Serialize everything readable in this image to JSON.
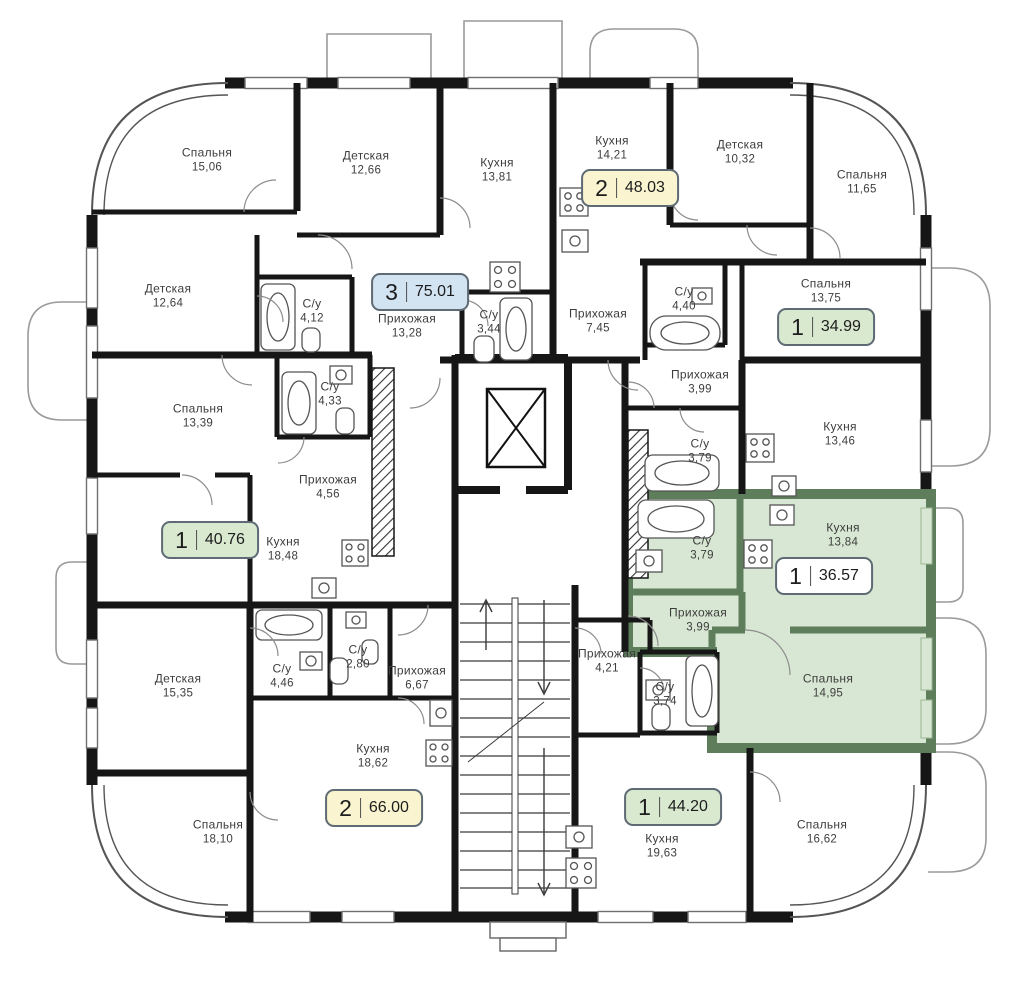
{
  "plan": {
    "language": "ru",
    "type": "residential-floor-plan",
    "colors": {
      "wall": "#161616",
      "highlight_wall": "#5e7d5a",
      "highlight_fill": "#d8e7d3",
      "badge_one_room": "#d8e9d0",
      "badge_two_room": "#faf5d0",
      "badge_three_room": "#d2e3f2",
      "badge_highlighted": "#ffffff"
    },
    "icons": {
      "elevator": "elevator-shaft-x",
      "stairs": "staircase-arrows",
      "bathtub": "bathtub-outline",
      "stove": "stove-4-burners",
      "sink": "sink-basin",
      "toilet": "toilet-outline",
      "door": "door-swing-arc"
    }
  },
  "apartments": [
    {
      "rooms": "3",
      "area": "75.01",
      "style": "blue"
    },
    {
      "rooms": "2",
      "area": "48.03",
      "style": "yellow"
    },
    {
      "rooms": "1",
      "area": "34.99",
      "style": "green"
    },
    {
      "rooms": "1",
      "area": "36.57",
      "style": "white",
      "highlighted": true
    },
    {
      "rooms": "1",
      "area": "40.76",
      "style": "green"
    },
    {
      "rooms": "2",
      "area": "66.00",
      "style": "yellow"
    },
    {
      "rooms": "1",
      "area": "44.20",
      "style": "green"
    }
  ],
  "rooms": [
    {
      "name": "Спальня",
      "area": "15,06"
    },
    {
      "name": "Детская",
      "area": "12,66"
    },
    {
      "name": "Кухня",
      "area": "13,81"
    },
    {
      "name": "Кухня",
      "area": "14,21"
    },
    {
      "name": "Детская",
      "area": "10,32"
    },
    {
      "name": "Спальня",
      "area": "11,65"
    },
    {
      "name": "Детская",
      "area": "12,64"
    },
    {
      "name": "С/у",
      "area": "4,12"
    },
    {
      "name": "Прихожая",
      "area": "13,28"
    },
    {
      "name": "С/у",
      "area": "3,44"
    },
    {
      "name": "Прихожая",
      "area": "7,45"
    },
    {
      "name": "С/у",
      "area": "4,40"
    },
    {
      "name": "Спальня",
      "area": "13,75"
    },
    {
      "name": "Прихожая",
      "area": "3,99"
    },
    {
      "name": "С/у",
      "area": "3,79"
    },
    {
      "name": "Кухня",
      "area": "13,46"
    },
    {
      "name": "С/у",
      "area": "3,79"
    },
    {
      "name": "Кухня",
      "area": "13,84"
    },
    {
      "name": "Прихожая",
      "area": "3,99"
    },
    {
      "name": "Спальня",
      "area": "14,95"
    },
    {
      "name": "Спальня",
      "area": "13,39"
    },
    {
      "name": "С/у",
      "area": "4,33"
    },
    {
      "name": "Прихожая",
      "area": "4,56"
    },
    {
      "name": "Кухня",
      "area": "18,48"
    },
    {
      "name": "Детская",
      "area": "15,35"
    },
    {
      "name": "С/у",
      "area": "4,46"
    },
    {
      "name": "С/у",
      "area": "2,80"
    },
    {
      "name": "Прихожая",
      "area": "6,67"
    },
    {
      "name": "Кухня",
      "area": "18,62"
    },
    {
      "name": "Спальня",
      "area": "18,10"
    },
    {
      "name": "Прихожая",
      "area": "4,21"
    },
    {
      "name": "С/у",
      "area": "3,74"
    },
    {
      "name": "Кухня",
      "area": "19,63"
    },
    {
      "name": "Спальня",
      "area": "16,62"
    }
  ]
}
